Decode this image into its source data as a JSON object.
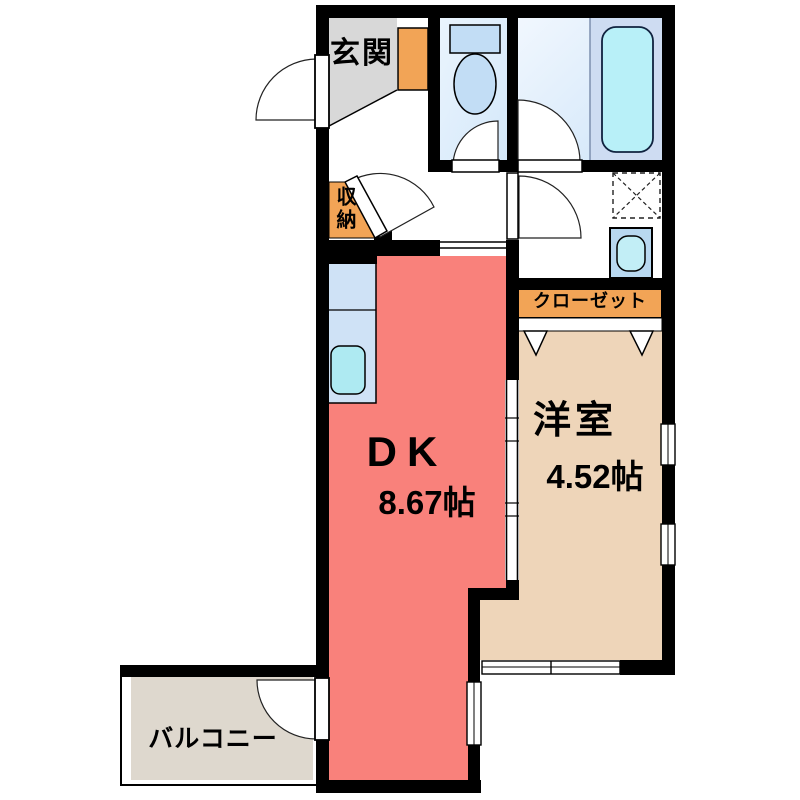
{
  "floorplan": {
    "rooms": {
      "genkan": {
        "label": "玄関"
      },
      "storage": {
        "label": "収納"
      },
      "closet": {
        "label": "クローゼット"
      },
      "dk": {
        "label": "DK",
        "size": "8.67帖"
      },
      "western": {
        "label": "洋室",
        "size": "4.52帖"
      },
      "balcony": {
        "label": "バルコニー"
      }
    },
    "fixtures": {
      "toilet": "toilet-icon",
      "bathtub": "bathtub-icon",
      "kitchen_sink": "kitchen-sink-icon",
      "washbasin": "washbasin-icon",
      "washer_space": "washing-machine-space",
      "door_swing": "door-swing-icon",
      "folding_door": "folding-door-icon",
      "window": "window-icon"
    },
    "colors": {
      "wall": "#000000",
      "dk_floor": "#f9817b",
      "western_floor": "#eed5b9",
      "accent_orange": "#f2a456",
      "genkan_floor": "#d8d8d8",
      "balcony_floor": "#ded8ce",
      "toilet_floor": "#dcecfa",
      "bath_floor": "#e2eefb",
      "tub_deck": "#cedcf2",
      "bathtub": "#b8f0f8",
      "fixture_blue": "#c2ddf5",
      "counter": "#cfe2f6",
      "counter_sink": "#aeeaf2",
      "basin": "#b8d8f0",
      "basin_sink": "#c2eef6"
    }
  }
}
